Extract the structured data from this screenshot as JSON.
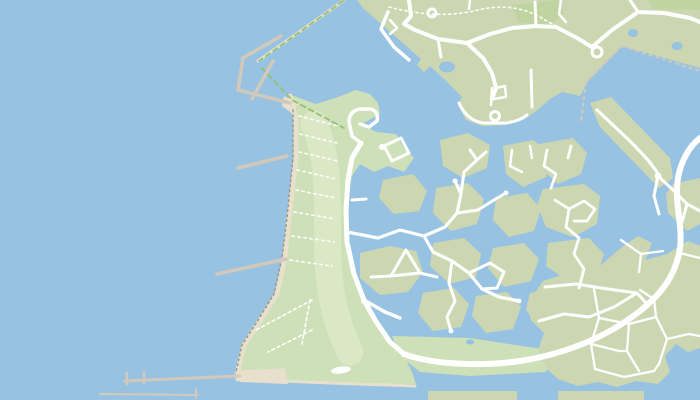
{
  "map": {
    "type": "vector-map",
    "description": "Coastal map: open sea on the west with breakwaters and piers, a beach park strip with footpaths, a harbour basin, and canal-island residential neighbourhoods with white road network to the east",
    "visible_text": [],
    "colors": {
      "water": "#98c2e2",
      "land": "#ccd7b2",
      "park": "#cde0b8",
      "park_inner": "#dbe8c6",
      "forest": "#bfd4a1",
      "road": "#ffffff",
      "sand": "#e8e0cd",
      "pier": "#d2c9ba",
      "trail": "#ffffff",
      "embankment": "#97987c",
      "dike": "#94c16f"
    },
    "features": {
      "sea": "open water (west half)",
      "harbor_breakwater": "angled breakwater arms at harbour entrance",
      "piers": [
        "north pier",
        "south pier",
        "long south breakwater with two stubs",
        "bottom quay pier"
      ],
      "beach_park": "green shore park with rows of dashed beach paths",
      "island_clusters": 2,
      "ponds": 4,
      "major_road": "wide arterial road curving along the south and east",
      "residential_area": "street grid on south-east peninsula"
    }
  }
}
